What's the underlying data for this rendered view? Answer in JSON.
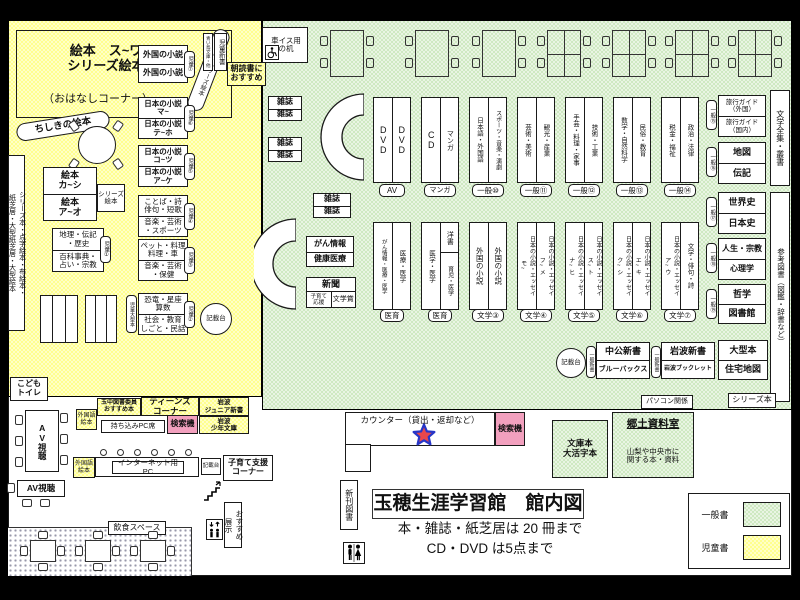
{
  "colors": {
    "general_green": "#cfe9c2",
    "children_yellow": "#ffff8f",
    "search_pink": "#f2a0be",
    "star_red": "#e8474b",
    "star_blue": "#2736c8"
  },
  "title_block": {
    "title": "玉穂生涯学習館　館内図",
    "note1": "本・雑誌・紙芝居は 20 冊まで",
    "note2": "CD・DVD は5点まで"
  },
  "legend": {
    "general_label": "一般書",
    "children_label": "児童書"
  },
  "children": {
    "ohanashi_main": "絵本　ス~ワ\nシリーズ絵本",
    "ohanashi_note": "（おはなしコーナー）",
    "ohanashi_curve": "昔話・シリーズ絵本",
    "chishiki": "ちしきの絵本",
    "left_strip": "シリーズ本・点字絵本・布絵本・\n紙芝居・大型紙芝居・大型絵本",
    "ehon_top": "絵本\nカ~シ",
    "ehon_bottom": "絵本\nア~オ",
    "series_side": "シリーズ\n絵本",
    "chiri_top": "地理・伝記\n・歴史",
    "chiri_bottom": "百科事典・\n占い・宗教",
    "chiri_tab": "児童①",
    "shelves": [
      {
        "c1": "外国の小説",
        "c2": "外国の小説",
        "tab": "児童⑦"
      },
      {
        "c1": "日本の小説\nマ~",
        "c2": "日本の小説\nテ~ホ",
        "tab": "児童⑥"
      },
      {
        "c1": "日本の小説\nコ~ツ",
        "c2": "日本の小説\nア~ケ",
        "tab": "児童⑤"
      },
      {
        "c1": "ことば・詩\n俳句・短歌",
        "c2": "音楽・芸術\n・スポーツ",
        "tab": "児童④"
      },
      {
        "c1": "ペット・料理\n料理・車",
        "c2": "音楽・芸術\n・保健",
        "tab": "児童③"
      },
      {
        "c1": "恐竜・星座\n算数",
        "c2": "社会・教育\nしごと・民話",
        "tab": "児童②"
      }
    ],
    "ogata_tab": "児童大型本",
    "kisaidai": "記載台",
    "kodomo_toilet": "こども\nトイレ"
  },
  "general": {
    "wheelchair_desk": "車イス用\nの机",
    "aoitori": "青い鳥文庫・他",
    "jido_shinsho": "児童新書",
    "asadoku": "朝読書に\nおすすめ",
    "zasshi": "雑誌",
    "gan_top": "がん情報",
    "gan_bottom": "健康医療",
    "shinbun": "新聞",
    "kosodate_ouen": "子育て\n応援",
    "bungakusho": "文学賞",
    "top_shelves": [
      {
        "c1": "DVD",
        "c2": "DVD",
        "label": "AV"
      },
      {
        "c1": "CD",
        "c2": "マンガ",
        "label": "マンガ"
      },
      {
        "c1": "日本語・外国語",
        "c2": "スポーツ・音楽・演劇",
        "label": "一般⑩"
      },
      {
        "c1": "芸術・美術",
        "c2": "観光・産業",
        "label": "一般⑪"
      },
      {
        "c1": "手芸・料理・家事",
        "c2": "技術・工業",
        "label": "一般⑫"
      },
      {
        "c1": "数学・自然科学",
        "c2": "民俗・教育",
        "label": "一般⑬"
      },
      {
        "c1": "税金・福祉",
        "c2": "政治・法律",
        "label": "一般⑭"
      }
    ],
    "bottom_shelves": [
      {
        "c1": "がん情報・医療・医学",
        "c2": "医療・医学",
        "label": "医育"
      },
      {
        "c1": "医学・医学",
        "c2a": "洋書",
        "c2b": "育児・医学",
        "label": "医育"
      },
      {
        "c1": "外国の小説",
        "c2": "外国の小説",
        "label": "文学③"
      },
      {
        "c1": "日本の小説・エッセイ\nモ~",
        "c2": "日本の小説・エッセイ\nフ~メ",
        "label": "文学④"
      },
      {
        "c1": "日本の小説・エッセイ\nナ~ヒ",
        "c2": "日本の小説・エッセイ\nス~ト",
        "label": "文学⑤"
      },
      {
        "c1": "日本の小説・エッセイ\nク~シ",
        "c2": "日本の小説・エッセイ\nエ~キ",
        "label": "文学⑥"
      },
      {
        "c1": "日本の小説・エッセイ\nア~ウ",
        "c2": "文学・俳句・詩",
        "label": "文学⑦"
      }
    ],
    "right_units": [
      {
        "tab": "一般⑮",
        "r1": "旅行ガイド\n（外国）",
        "r2": "旅行ガイド\n（国内）"
      },
      {
        "tab": "一般⑯",
        "r1": "地図",
        "r2": "伝記"
      },
      {
        "tab": "一般⑰",
        "r1": "世界史",
        "r2": "日本史"
      },
      {
        "tab": "一般⑱",
        "r1": "人生・宗教",
        "r2": "心理学"
      },
      {
        "tab": "一般⑲",
        "r1": "哲学",
        "r2": "図書館"
      }
    ],
    "strip_bungaku": "文学全集・叢書",
    "strip_sanko": "参考図書（図鑑・辞書など）",
    "kisaidai": "記載台",
    "shinsho_units": [
      {
        "tab": "一般新書",
        "r1": "中公新書",
        "r2": "ブルーバックス"
      },
      {
        "tab": "一般新書",
        "r1": "岩波新書",
        "r2": "岩波ブックレット"
      }
    ],
    "ogata_r1": "大型本",
    "ogata_r2": "住宅地図",
    "pasokon": "パソコン関係",
    "series_label": "シリーズ本"
  },
  "counter": {
    "label": "カウンター（貸出・返却など）",
    "kensakuki": "検索機",
    "bunko": "文庫本\n大活字本",
    "kyodo_title": "郷土資料室",
    "kyodo_note": "山梨や中央市に\n関する本・資料",
    "shinkan": "新刊図書"
  },
  "south": {
    "av": "AV視聴",
    "gaikokugo": "外国語\n絵本",
    "tamachu": "玉中図書委員\nおすすめ本",
    "teens": "ティーンズ\nコーナー",
    "iwanami_jr": "岩波\nジュニア新書",
    "mochikomi": "持ち込みPC席",
    "kensakuki": "検索機",
    "iwanami_shonen": "岩波\n少年文庫",
    "internet": "インターネット用PC",
    "kisaidai": "記載台",
    "kosodate": "子育て支援\nコーナー",
    "osusume": "おすすめ\n展示",
    "inshoku": "飲食スペース"
  }
}
